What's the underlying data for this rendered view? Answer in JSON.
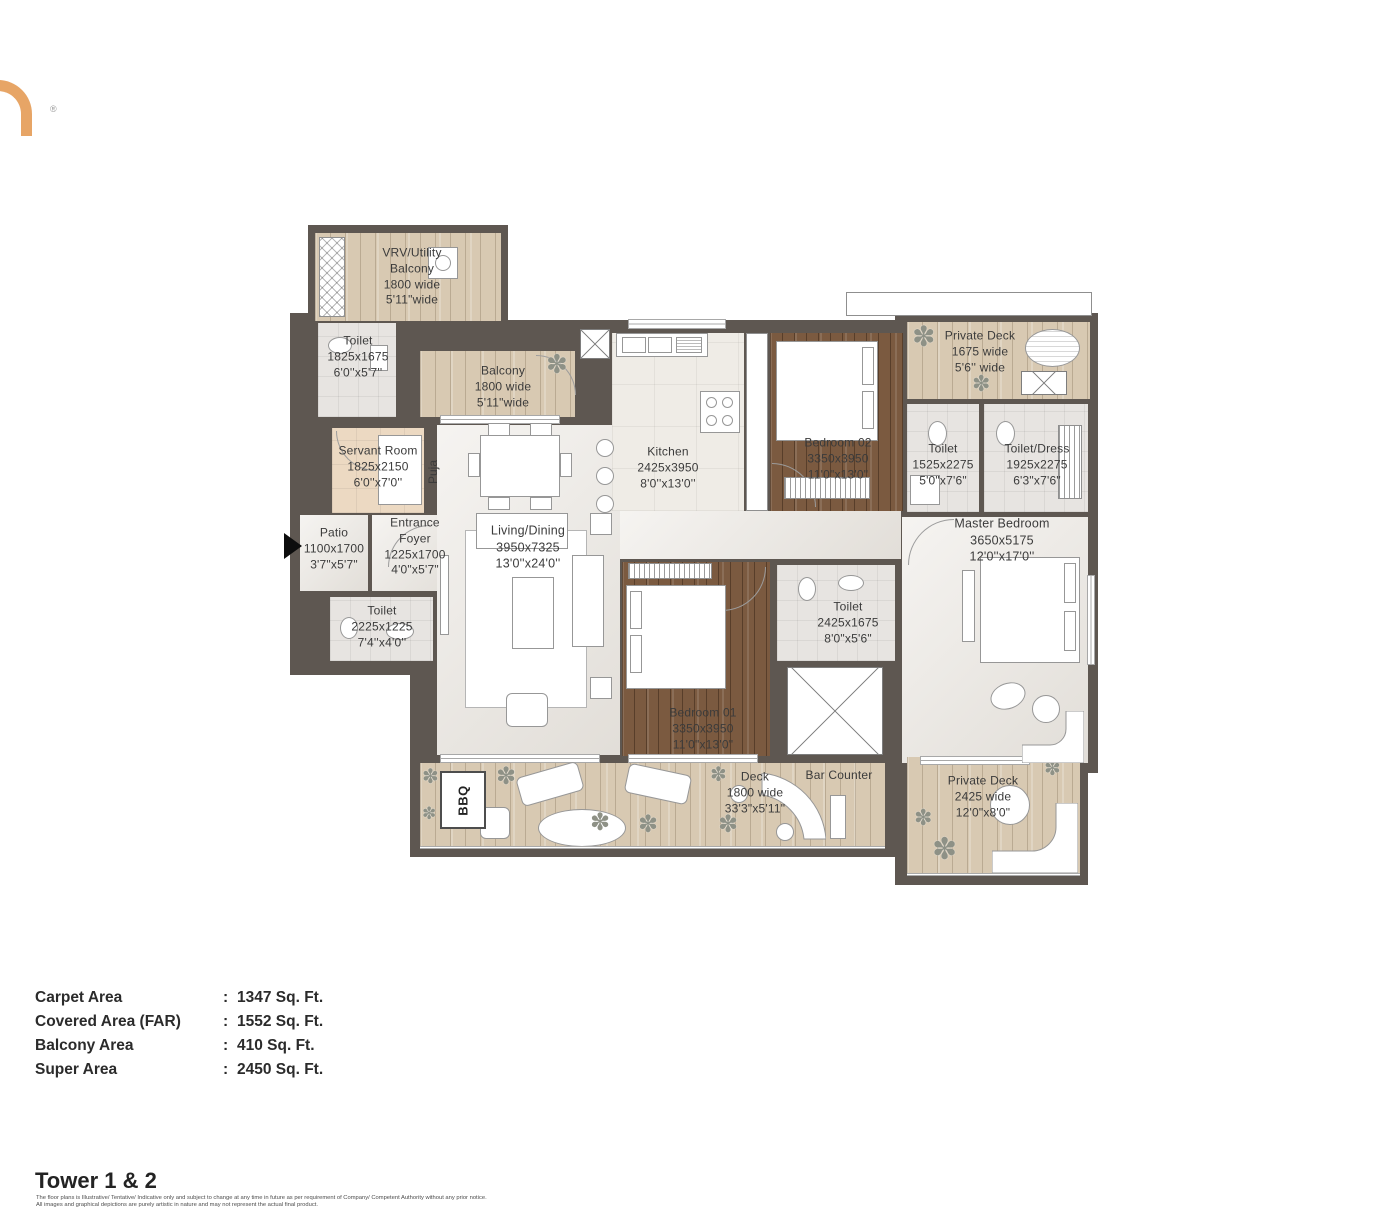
{
  "logo": {
    "registered_mark": "®"
  },
  "plan": {
    "rooms": [
      {
        "name": "VRV/Utility\nBalcony",
        "metric": "1800 wide",
        "imperial": "5'11\"wide"
      },
      {
        "name": "Toilet",
        "metric": "1825x1675",
        "imperial": "6'0''x5'7''"
      },
      {
        "name": "Balcony",
        "metric": "1800 wide",
        "imperial": "5'11\"wide"
      },
      {
        "name": "Servant Room",
        "metric": "1825x2150",
        "imperial": "6'0''x7'0''"
      },
      {
        "name": "Patio",
        "metric": "1100x1700",
        "imperial": "3'7\"x5'7\""
      },
      {
        "name": "Entrance\nFoyer",
        "metric": "1225x1700",
        "imperial": "4'0\"x5'7\""
      },
      {
        "name": "Toilet",
        "metric": "2225x1225",
        "imperial": "7'4''x4'0''"
      },
      {
        "name": "Living/Dining",
        "metric": "3950x7325",
        "imperial": "13'0''x24'0''"
      },
      {
        "name": "Kitchen",
        "metric": "2425x3950",
        "imperial": "8'0''x13'0''"
      },
      {
        "name": "Bedroom 02",
        "metric": "3350x3950",
        "imperial": "11'0\"x13'0\""
      },
      {
        "name": "Private Deck",
        "metric": "1675 wide",
        "imperial": "5'6'' wide"
      },
      {
        "name": "Toilet",
        "metric": "1525x2275",
        "imperial": "5'0\"x7'6\""
      },
      {
        "name": "Toilet/Dress",
        "metric": "1925x2275",
        "imperial": "6'3\"x7'6\""
      },
      {
        "name": "Master Bedroom",
        "metric": "3650x5175",
        "imperial": "12'0''x17'0''"
      },
      {
        "name": "Toilet",
        "metric": "2425x1675",
        "imperial": "8'0\"x5'6\""
      },
      {
        "name": "Bedroom 01",
        "metric": "3350x3950",
        "imperial": "11'0\"x13'0\""
      },
      {
        "name": "Deck",
        "metric": "1800 wide",
        "imperial": "33'3\"x5'11\""
      },
      {
        "name": "Bar Counter",
        "metric": "",
        "imperial": ""
      },
      {
        "name": "Private Deck",
        "metric": "2425 wide",
        "imperial": "12'0\"x8'0\""
      }
    ],
    "vertical_labels": {
      "puja": "Puja",
      "bbq": "BBQ"
    }
  },
  "areas": {
    "colon": ":",
    "rows": [
      {
        "label": "Carpet Area",
        "value": "1347 Sq. Ft."
      },
      {
        "label": "Covered Area (FAR)",
        "value": "1552 Sq. Ft."
      },
      {
        "label": "Balcony Area",
        "value": "410 Sq. Ft."
      },
      {
        "label": "Super Area",
        "value": "2450 Sq. Ft."
      }
    ]
  },
  "footer": {
    "title": "Tower 1 & 2",
    "disclaimer_line1": "The floor plans is Illustrative/ Tentative/ Indicative only and subject to change at any time in future as per requirement of Company/ Competent Authority without any prior notice.",
    "disclaimer_line2": "All images and graphical depictions are purely artistic in nature and may not represent the actual final product."
  },
  "colors": {
    "accent_orange": "#e7a566",
    "wall": "#5e5751",
    "wood_light": "#d8c9b2",
    "wood_dark": "#7b5a40"
  }
}
